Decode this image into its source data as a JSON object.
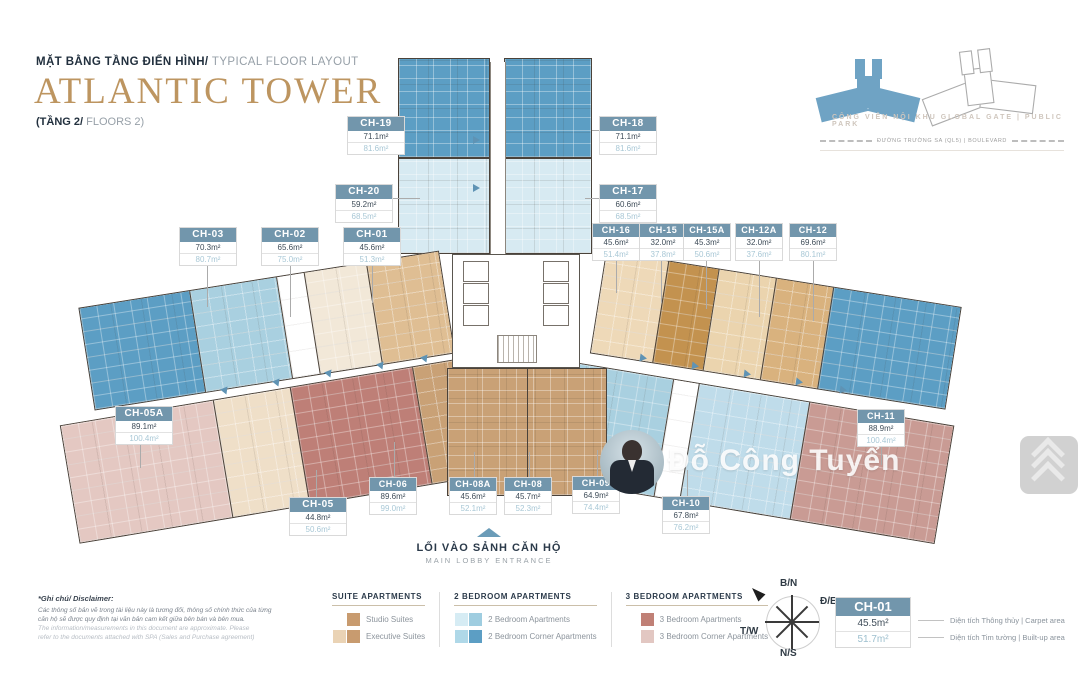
{
  "header": {
    "subtitle_vn": "MẶT BẰNG TẦNG ĐIỂN HÌNH/",
    "subtitle_en": " TYPICAL FLOOR LAYOUT",
    "title": "ATLANTIC TOWER",
    "floor_vn": "(TẦNG 2/",
    "floor_en": " FLOORS 2)"
  },
  "site": {
    "park": "CÔNG VIÊN NỘI KHU GLOBAL GATE | PUBLIC PARK",
    "road": "ĐƯỜNG TRƯỜNG SA (QL5) | BOULEVARD"
  },
  "units": [
    {
      "id": "CH-19",
      "carpet": "71.1m²",
      "built": "81.6m²"
    },
    {
      "id": "CH-18",
      "carpet": "71.1m²",
      "built": "81.6m²"
    },
    {
      "id": "CH-20",
      "carpet": "59.2m²",
      "built": "68.5m²"
    },
    {
      "id": "CH-17",
      "carpet": "60.6m²",
      "built": "68.5m²"
    },
    {
      "id": "CH-03",
      "carpet": "70.3m²",
      "built": "80.7m²"
    },
    {
      "id": "CH-02",
      "carpet": "65.6m²",
      "built": "75.0m²"
    },
    {
      "id": "CH-01",
      "carpet": "45.6m²",
      "built": "51.3m²"
    },
    {
      "id": "CH-16",
      "carpet": "45.6m²",
      "built": "51.4m²"
    },
    {
      "id": "CH-15",
      "carpet": "32.0m²",
      "built": "37.8m²"
    },
    {
      "id": "CH-15A",
      "carpet": "45.3m²",
      "built": "50.6m²"
    },
    {
      "id": "CH-12A",
      "carpet": "32.0m²",
      "built": "37.6m²"
    },
    {
      "id": "CH-12",
      "carpet": "69.6m²",
      "built": "80.1m²"
    },
    {
      "id": "CH-05A",
      "carpet": "89.1m²",
      "built": "100.4m²"
    },
    {
      "id": "CH-11",
      "carpet": "88.9m²",
      "built": "100.4m²"
    },
    {
      "id": "CH-05",
      "carpet": "44.8m²",
      "built": "50.6m²"
    },
    {
      "id": "CH-06",
      "carpet": "89.6m²",
      "built": "99.0m²"
    },
    {
      "id": "CH-08A",
      "carpet": "45.6m²",
      "built": "52.1m²"
    },
    {
      "id": "CH-08",
      "carpet": "45.7m²",
      "built": "52.3m²"
    },
    {
      "id": "CH-09",
      "carpet": "64.9m²",
      "built": "74.4m²"
    },
    {
      "id": "CH-10",
      "carpet": "67.8m²",
      "built": "76.2m²"
    }
  ],
  "entrance": {
    "title": "LỐI VÀO SẢNH CĂN HỘ",
    "subtitle": "MAIN LOBBY ENTRANCE"
  },
  "legend": {
    "groups": [
      {
        "title": "SUITE APARTMENTS",
        "items": [
          {
            "label": "Studio Suites",
            "swatches": [
              "#C89B6F"
            ]
          },
          {
            "label": "Executive Suites",
            "swatches": [
              "#EAD3B5",
              "#C89B6F"
            ]
          }
        ]
      },
      {
        "title": "2 BEDROOM APARTMENTS",
        "items": [
          {
            "label": "2 Bedroom Apartments",
            "swatches": [
              "#D6ECF4",
              "#9FCDE0"
            ]
          },
          {
            "label": "2 Bedroom Corner Apartments",
            "swatches": [
              "#AFD8E8",
              "#5C9EC4"
            ]
          }
        ]
      },
      {
        "title": "3 BEDROOM APARTMENTS",
        "items": [
          {
            "label": "3 Bedroom Apartments",
            "swatches": [
              "#C08076"
            ]
          },
          {
            "label": "3 Bedroom Corner Apartments",
            "swatches": [
              "#E2C7C2"
            ]
          }
        ]
      }
    ]
  },
  "compass": {
    "north": "B/N",
    "east": "Đ/E",
    "west": "T/W",
    "south": "N/S"
  },
  "sample": {
    "id": "CH-01",
    "carpet": "45.5m²",
    "built": "51.7m²",
    "carpet_note": "Diện tích Thông thủy | Carpet area",
    "built_note": "Diện tích Tim tường | Built-up area"
  },
  "disclaimer": {
    "heading": "*Ghi chú/ Disclaimer:",
    "lines": [
      "Các thông số bản vẽ trong tài liệu này là tương đối, thông số chính thức của từng",
      "căn hộ sẽ được quy định tại văn bản cam kết giữa bên bán và bên mua.",
      "The information/measurements in this document are approximate. Please",
      "refer to the documents attached with SPA (Sales and Purchase agreement)"
    ]
  },
  "watermark": {
    "name": "Đỗ Công Tuyển"
  },
  "colors": {
    "accent_gold": "#BD9560",
    "label_header": "#7296AC",
    "navy": "#2B3A4A",
    "two_br_corner": "#5C9EC4",
    "two_br": "#A9D0E0",
    "two_br_pale": "#D7EAF2",
    "suite_dark": "#C3924F",
    "suite": "#D9B27E",
    "suite_light": "#EED9B8",
    "cream": "#F2E8D8",
    "three_br": "#BE7F77",
    "three_br_corner": "#E4C8C2",
    "rose_mid": "#C99B94",
    "tan_core": "#C9A176"
  }
}
